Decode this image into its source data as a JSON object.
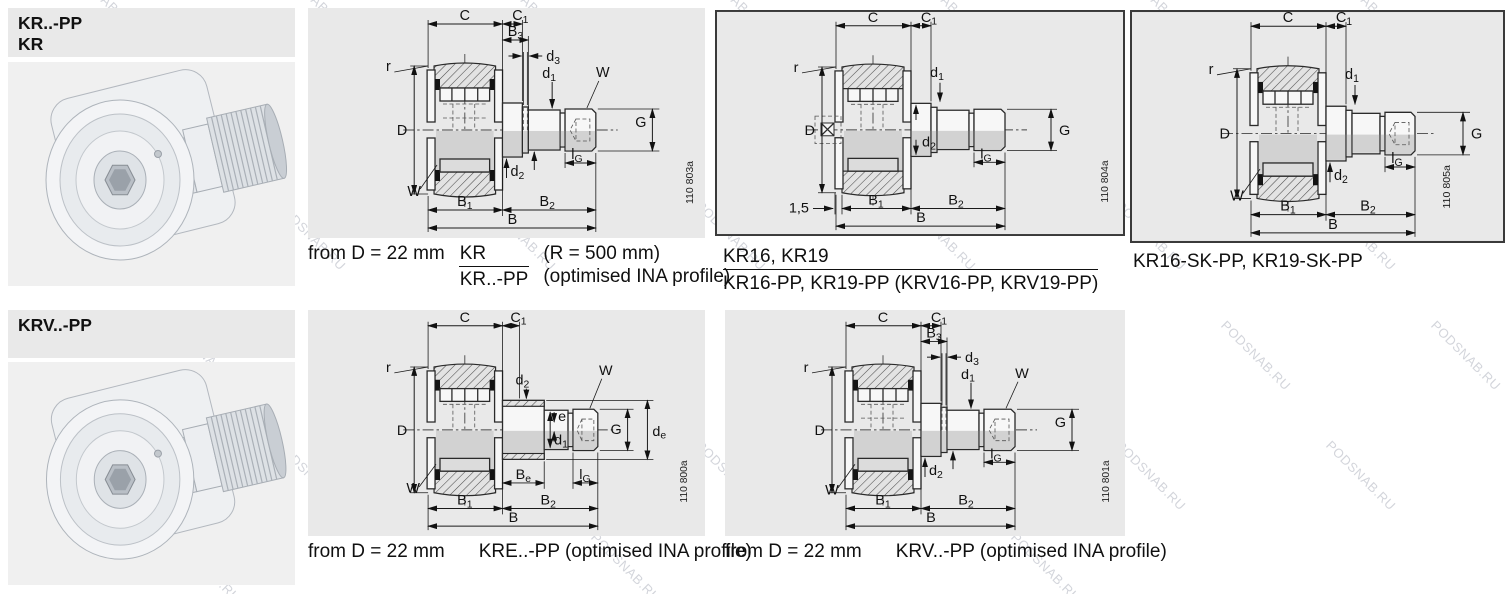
{
  "watermark": {
    "text": "PODSNAB.RU"
  },
  "headers": {
    "kr": {
      "line1": "KR..-PP",
      "line2": "KR"
    },
    "krv": {
      "line1": "KRV..-PP"
    }
  },
  "labels": {
    "C": "C",
    "C1": [
      "C",
      "1"
    ],
    "B3": [
      "B",
      "3"
    ],
    "d3": [
      "d",
      "3"
    ],
    "d1": [
      "d",
      "1"
    ],
    "d2": [
      "d",
      "2"
    ],
    "de": [
      "d",
      "e"
    ],
    "Be": [
      "B",
      "e"
    ],
    "lG": [
      "l",
      "G"
    ],
    "B1": [
      "B",
      "1"
    ],
    "B2": [
      "B",
      "2"
    ],
    "B": "B",
    "D": "D",
    "G": "G",
    "W": "W",
    "r": "r",
    "e": "e",
    "gap15": "1,5"
  },
  "figures": {
    "a": {
      "code": "110 803a"
    },
    "b": {
      "code": "110 804a"
    },
    "c": {
      "code": "110 805a"
    },
    "d": {
      "code": "110 800a"
    },
    "e": {
      "code": "110 801a"
    }
  },
  "captions": {
    "a": {
      "prefix": "from D = 22 mm",
      "frac_top": "KR",
      "frac_bottom": "KR..-PP",
      "note_top": "(R = 500 mm)",
      "note_bottom": "(optimised INA profile)"
    },
    "b": {
      "line1": "KR16, KR19",
      "line2": "KR16-PP, KR19-PP (KRV16-PP, KRV19-PP)"
    },
    "c": {
      "line1": "KR16-SK-PP, KR19-SK-PP"
    },
    "d": {
      "prefix": "from D = 22 mm",
      "text": "KRE..-PP (optimised INA profile)"
    },
    "e": {
      "prefix": "from D = 22 mm",
      "text": "KRV..-PP (optimised INA profile)"
    }
  },
  "colors": {
    "panel_bg": "#e9e9e9",
    "photo_bg": "#f0f0f0",
    "line": "#2a2a2a",
    "section_shade": "#d2d2d2",
    "watermark": "#969caa",
    "frame": "#3a3a3a"
  }
}
